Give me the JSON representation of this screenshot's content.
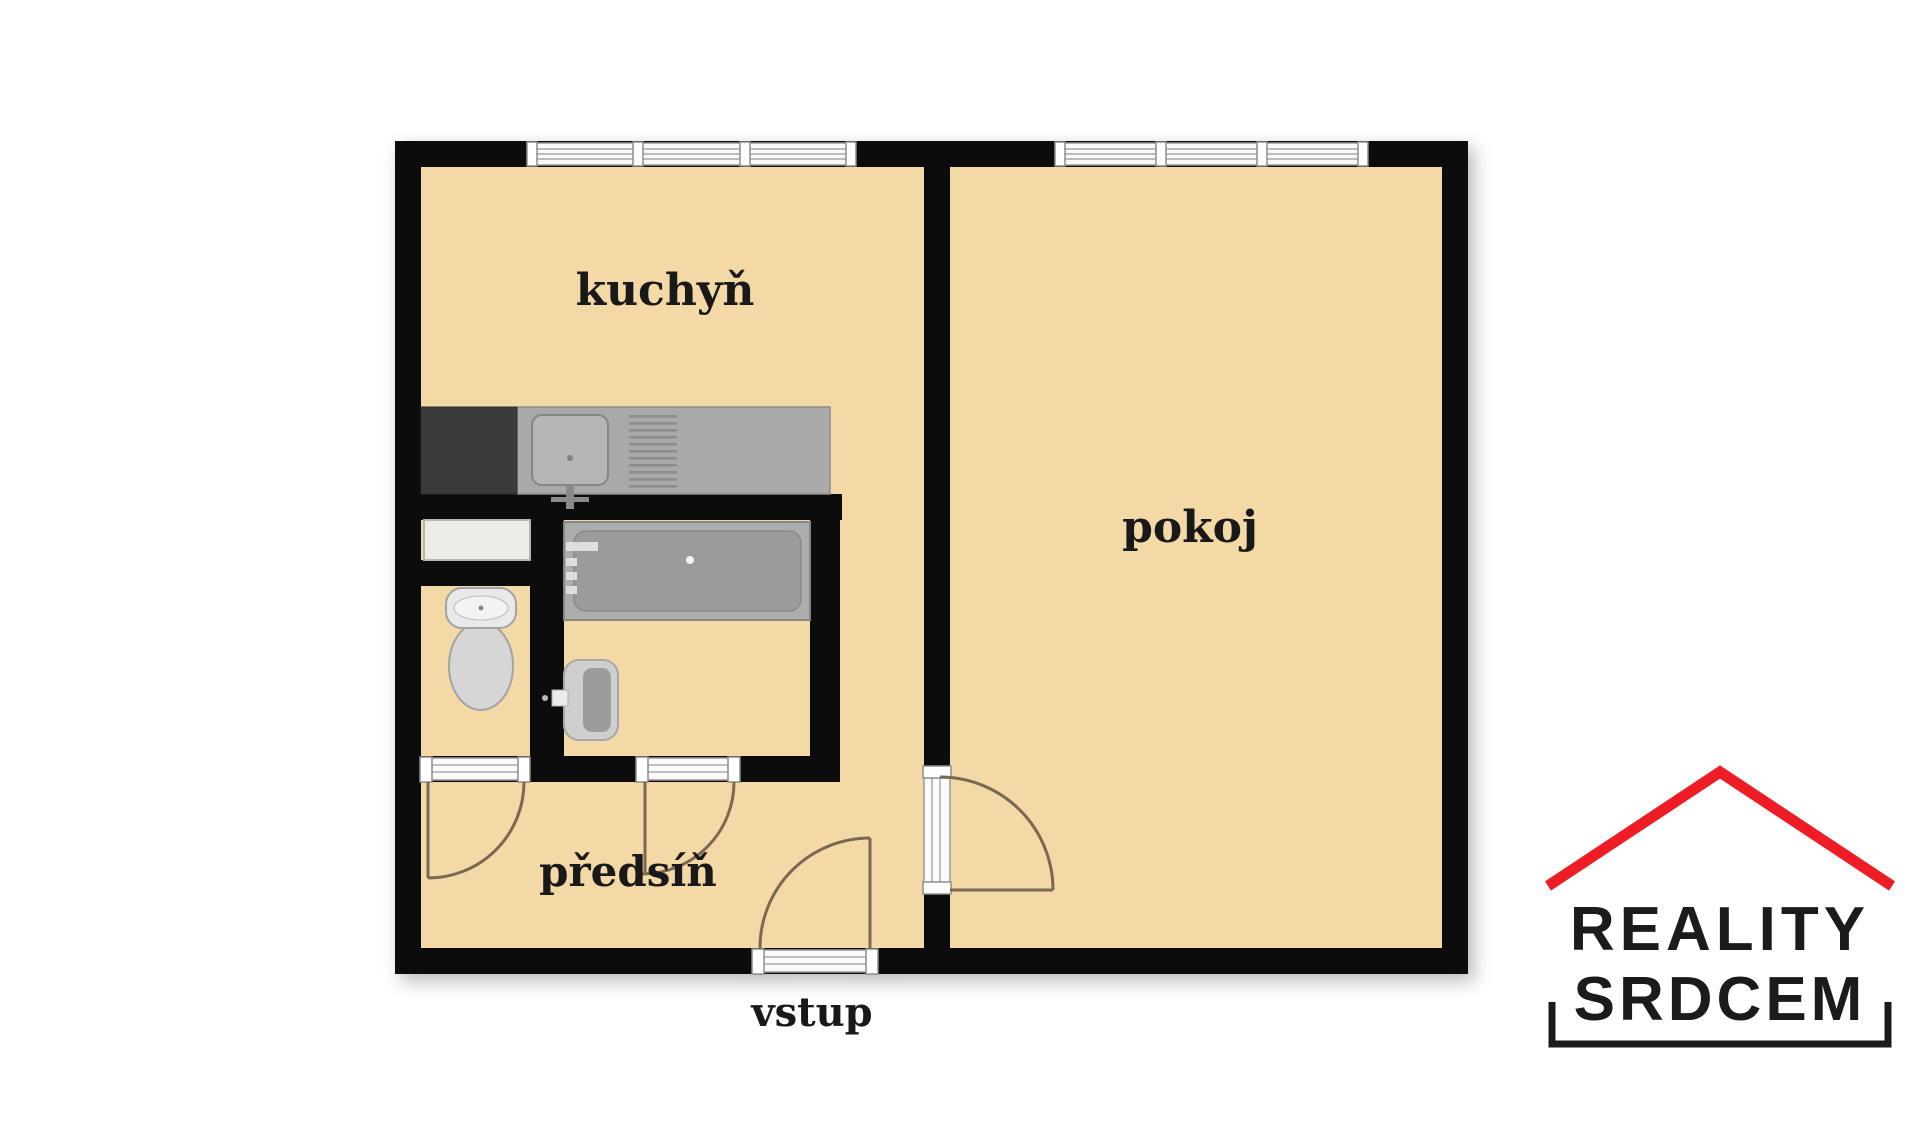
{
  "floorplan": {
    "labels": {
      "kitchen": "kuchyň",
      "living_room": "pokoj",
      "hallway": "předsíň",
      "entrance": "vstup"
    },
    "colors": {
      "floor": "#f2d9a6",
      "wall": "#0c0c0c",
      "counter": "#a9a9a9",
      "stove": "#3b3b3b",
      "bathtub": "#9b9b9b",
      "fixture_light": "#d6d6d6",
      "door_swing": "#7a6850",
      "window_band": "#fafafa"
    }
  },
  "logo": {
    "line1": "REALITY",
    "line2": "SRDCEM",
    "roof_color": "#ee1c25",
    "text_color": "#1d1b1a"
  }
}
